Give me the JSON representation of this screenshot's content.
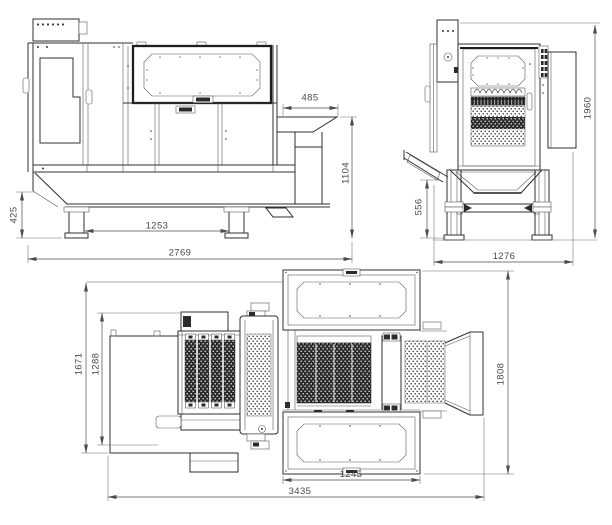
{
  "drawing": {
    "side_view": {
      "dim_hood_width": "485",
      "dim_outlet_height": "1104",
      "dim_base_height": "425",
      "dim_leg_spacing": "1253",
      "dim_overall_length": "2769"
    },
    "front_view": {
      "dim_overall_height": "1960",
      "dim_infeed_height": "556",
      "dim_overall_width": "1276"
    },
    "plan_view": {
      "dim_overall_depth": "1671",
      "dim_frame_depth": "1288",
      "dim_right_depth": "1808",
      "dim_panel_width": "1245",
      "dim_overall_length": "3435"
    }
  },
  "colors": {
    "line": "#2f2f2f",
    "detail": "#555555",
    "dimension": "#4d4d4d",
    "perforation_dark": "#2b2b2b",
    "background": "#ffffff"
  }
}
